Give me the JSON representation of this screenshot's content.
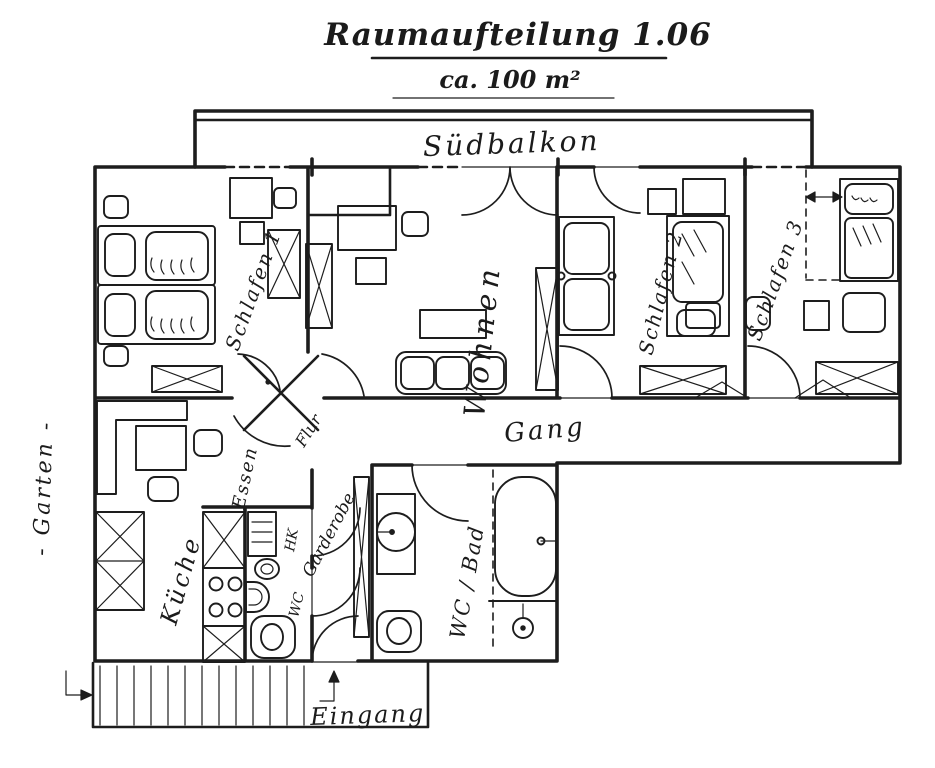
{
  "document": {
    "title": "Raumaufteilung 1.06",
    "subtitle": "ca. 100 m²"
  },
  "rooms": {
    "balcony": {
      "label": "Südbalkon"
    },
    "bedroom1": {
      "label": "Schlafen 1"
    },
    "living": {
      "label": "Wohnen"
    },
    "bedroom2": {
      "label": "Schlafen 2"
    },
    "bedroom3": {
      "label": "Schlafen 3"
    },
    "corridor": {
      "label": "Gang"
    },
    "dining": {
      "label": "Essen"
    },
    "kitchen": {
      "label": "Küche"
    },
    "hall": {
      "label": "Flur"
    },
    "cloakroom": {
      "label": "Garderobe"
    },
    "wc": {
      "label": "WC"
    },
    "bathroom": {
      "label": "WC / Bad"
    },
    "entrance": {
      "label": "Eingang"
    },
    "garden": {
      "label": "- Garten -"
    }
  },
  "annotations": {
    "radiator": "HK"
  },
  "colors": {
    "ink": "#1d1d1d",
    "paper": "#ffffff"
  }
}
